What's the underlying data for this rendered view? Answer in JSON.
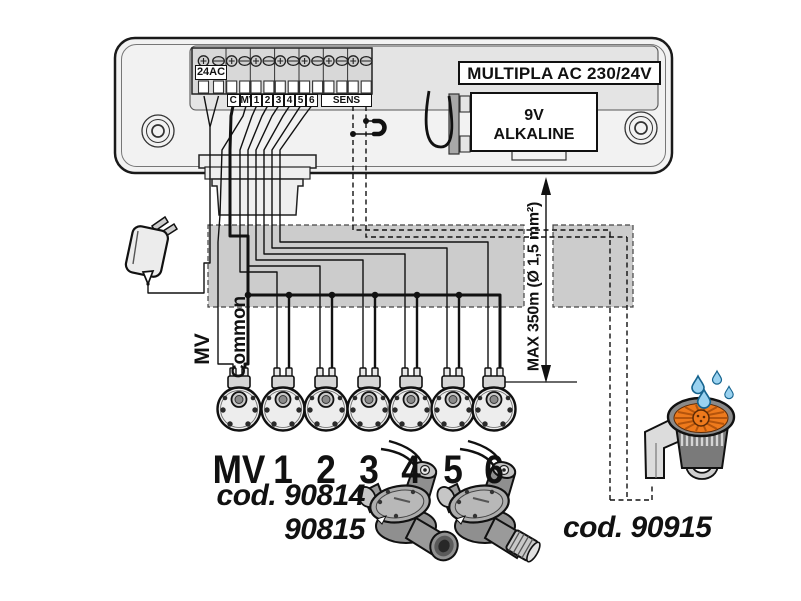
{
  "diagram": {
    "controller": {
      "title": "MULTIPLA AC 230/24V",
      "battery_line1": "9V",
      "battery_line2": "ALKALINE",
      "power_label": "24AC",
      "terminals": [
        "C",
        "MV",
        "1",
        "2",
        "3",
        "4",
        "5",
        "6",
        "SENS"
      ]
    },
    "wiring": {
      "mv_label": "MV",
      "common_label": "Common",
      "max_run_label": "MAX 350m (Ø 1,5 mm²)"
    },
    "valves": {
      "labels": [
        "MV",
        "1",
        "2",
        "3",
        "4",
        "5",
        "6"
      ]
    },
    "products": {
      "valve_prefix": "cod.",
      "valve_code1": "90814",
      "valve_code2": "90815",
      "sprinkler_prefix": "cod.",
      "sprinkler_code": "90915"
    },
    "colors": {
      "accent_orange": "#ee7a1c",
      "spoke_orange": "#b4540c",
      "droplet_blue": "#9ad2f0",
      "conduit_gray": "#cccccc",
      "line": "#111111"
    }
  }
}
